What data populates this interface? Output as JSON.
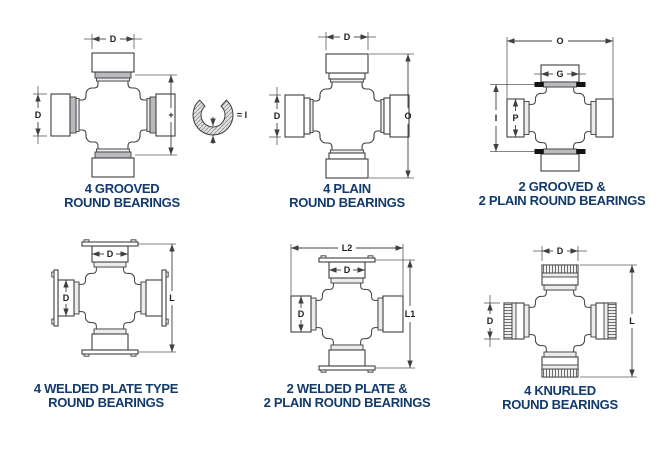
{
  "figure": {
    "background": "#ffffff",
    "accent_color": "#123a6d",
    "line_color": "#3f3f3f"
  },
  "diagrams": [
    {
      "name": "4-grooved-round-bearings",
      "caption_line1": "4 GROOVED",
      "caption_line2": "ROUND BEARINGS",
      "dims": {
        "top": "D",
        "left": "D",
        "plus": "+",
        "ring_equals": "= I"
      }
    },
    {
      "name": "4-plain-round-bearings",
      "caption_line1": "4 PLAIN",
      "caption_line2": "ROUND BEARINGS",
      "dims": {
        "top": "D",
        "left": "D",
        "right": "O"
      }
    },
    {
      "name": "2-grooved-2-plain-round-bearings",
      "caption_line1": "2 GROOVED &",
      "caption_line2": "2 PLAIN ROUND BEARINGS",
      "dims": {
        "overall_width": "O",
        "cap": "G",
        "overall_height": "I",
        "cap_inner": "P"
      }
    },
    {
      "name": "4-welded-plate-type-round-bearings",
      "caption_line1": "4 WELDED PLATE TYPE",
      "caption_line2": "ROUND BEARINGS",
      "dims": {
        "cap_top": "D",
        "cap_left": "D",
        "right": "L"
      }
    },
    {
      "name": "2-welded-plate-2-plain-round-bearings",
      "caption_line1": "2 WELDED PLATE &",
      "caption_line2": "2 PLAIN ROUND BEARINGS",
      "dims": {
        "overall_width": "L2",
        "cap_top": "D",
        "cap_left": "D",
        "right": "L1"
      }
    },
    {
      "name": "4-knurled-round-bearings",
      "caption_line1": "4 KNURLED",
      "caption_line2": "ROUND BEARINGS",
      "dims": {
        "top": "D",
        "left": "D",
        "right": "L"
      }
    }
  ]
}
